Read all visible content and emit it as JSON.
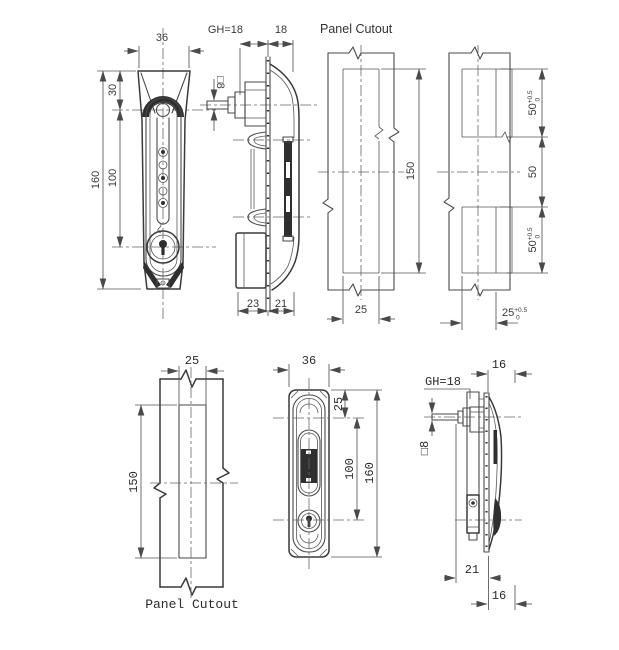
{
  "drawing": {
    "top_row": {
      "front_view": {
        "width": "36",
        "top_offset": "30",
        "overall_height": "160",
        "lock_spacing": "100"
      },
      "side_view": {
        "grip_height": "GH=18",
        "behind_panel": "18",
        "square_spindle": "□8",
        "front_depth": "23",
        "rear_depth": "21"
      },
      "panel_cutout": {
        "title": "Panel Cutout",
        "cutout_height": "150",
        "cutout_width": "25"
      },
      "edge_cutout": {
        "upper_height": "50",
        "upper_tol_plus": "+0.5",
        "upper_tol_minus": "0",
        "middle_gap": "50",
        "lower_height": "50",
        "lower_tol_plus": "+0.5",
        "lower_tol_minus": "0",
        "cutout_width": "25",
        "width_tol_plus": "+0.5",
        "width_tol_minus": "0"
      }
    },
    "bottom_row": {
      "panel_cutout": {
        "cutout_width": "25",
        "cutout_height": "150",
        "title": "Panel Cutout"
      },
      "front_view": {
        "width": "36",
        "top_offset": "25",
        "lock_spacing": "100",
        "overall_height": "160"
      },
      "side_view": {
        "top_depth": "16",
        "grip_height": "GH=18",
        "square_spindle": "□8",
        "front_depth": "21",
        "bottom_depth": "16"
      }
    }
  }
}
